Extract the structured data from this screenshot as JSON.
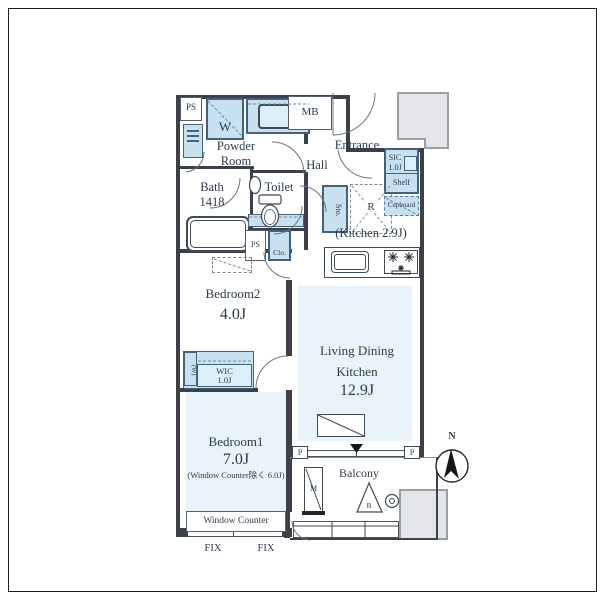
{
  "colors": {
    "room_fill": "#e9f3fa",
    "fixture_fill": "#c7e1f0",
    "wall": "#3b4049",
    "gray_block": "#e4e5e8",
    "text": "#2e3b4c"
  },
  "plan": {
    "utility": {
      "ps_top": "PS",
      "washer": "W",
      "meter_box": "MB",
      "powder_room": "Powder\nRoom",
      "bath": "Bath\n1418",
      "toilet": "Toilet",
      "ps_mid": "PS",
      "closet": "Clo."
    },
    "entry": {
      "entrance": "Entrance",
      "hall": "Hall",
      "sic": "SIC\n1.0J",
      "shelf": "Shelf",
      "cupboard": "Cupboard",
      "storage": "Sto.",
      "refrigerator": "R"
    },
    "kitchen": {
      "label": "(Kitchen 2.9J)"
    },
    "ldk": {
      "line1": "Living Dining",
      "line2": "Kitchen",
      "size": "12.9J"
    },
    "bedroom2": {
      "name": "Bedroom2",
      "size": "4.0J"
    },
    "wic": {
      "name": "WIC",
      "size": "1.0J",
      "w_mark": "(W)"
    },
    "bedroom1": {
      "name": "Bedroom1",
      "size": "7.0J",
      "note": "(Window Counter除く 6.0J)",
      "window_counter": "Window Counter",
      "fix_left": "FIX",
      "fix_right": "FIX"
    },
    "balcony": {
      "name": "Balcony",
      "meter": "M",
      "hatch": "B",
      "pillar_left": "P",
      "pillar_right": "P"
    },
    "compass": {
      "north": "N"
    }
  }
}
